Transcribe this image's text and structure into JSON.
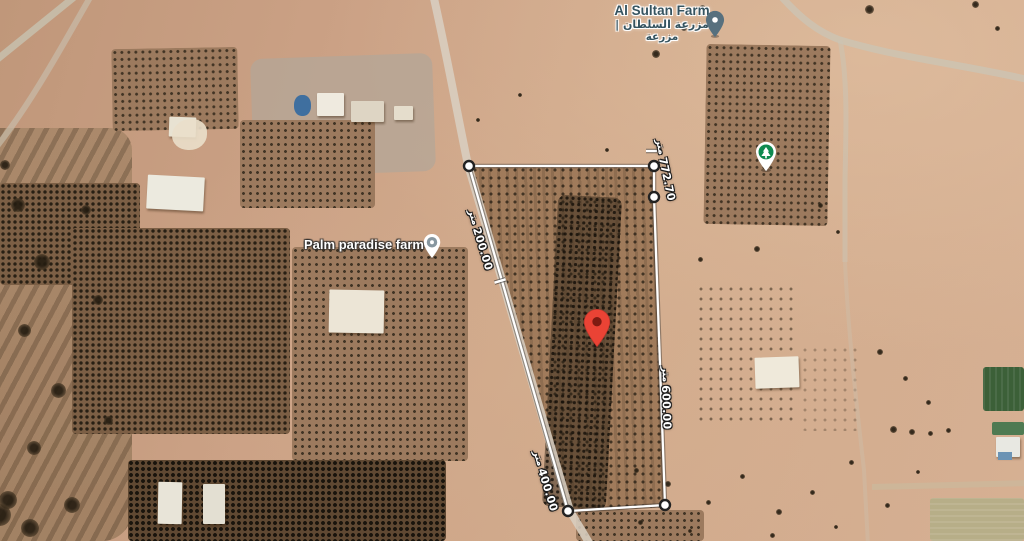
{
  "places": {
    "al_sultan_farm": {
      "name": "Al Sultan Farm",
      "name_arabic": "| مزرعة السلطان",
      "name_arabic_secondary": "مزرعة"
    },
    "palm_paradise_farm": {
      "name": "Palm paradise farm"
    }
  },
  "measurements": {
    "unit": "متر",
    "segments": [
      {
        "id": "north-east-edge",
        "value": "772.70"
      },
      {
        "id": "west-edge-upper",
        "value": "200.00"
      },
      {
        "id": "east-edge",
        "value": "600.00"
      },
      {
        "id": "west-edge-lower",
        "value": "400.00"
      }
    ]
  },
  "markers": {
    "al_sultan_pin_color": "#57707E",
    "palm_paradise_pin_color": "#8797A0",
    "park_tree_pin_color": "#0F8A50",
    "dropped_pin_color": "#EA4335",
    "dropped_pin_inner_color": "#7E1B12"
  },
  "measure_style": {
    "line_color": "#FFFFFF",
    "vertex_fill": "#FFFFFF",
    "vertex_stroke": "#222222"
  }
}
